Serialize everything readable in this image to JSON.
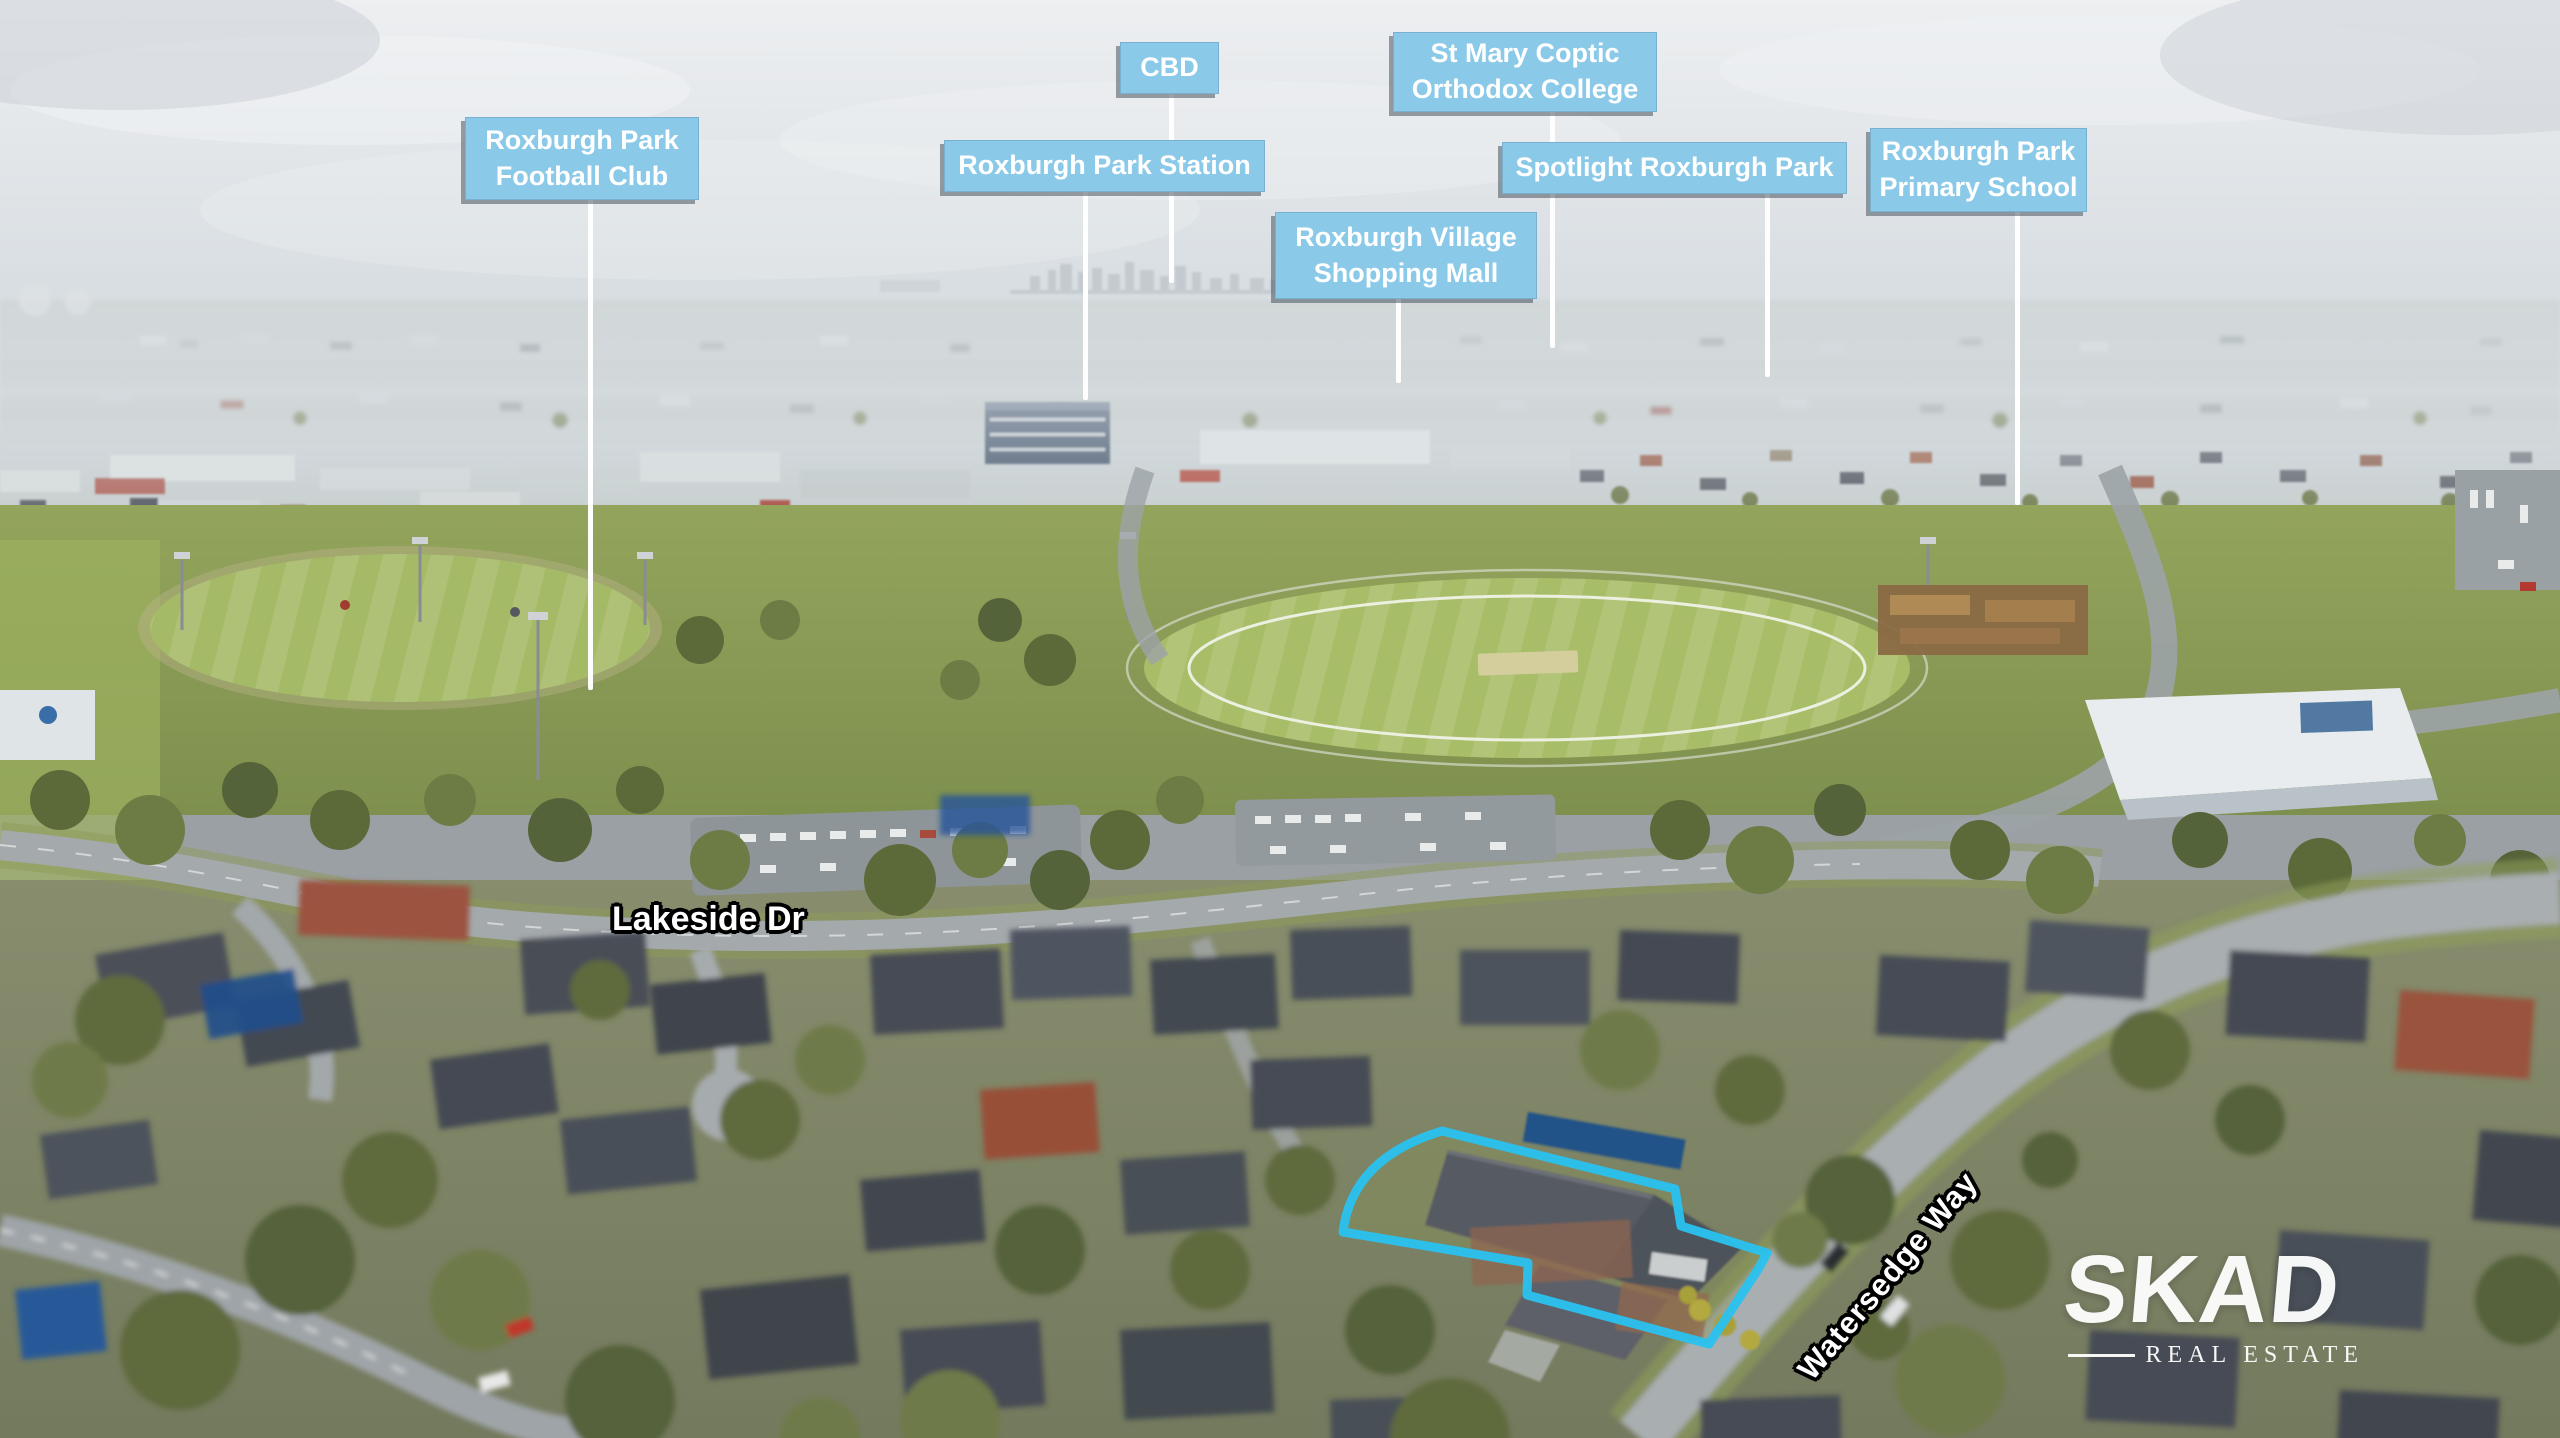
{
  "image_type": "aerial-drone-real-estate-photo",
  "callouts": [
    {
      "text": "Roxburgh Park\nFootball Club"
    },
    {
      "text": "CBD"
    },
    {
      "text": "Roxburgh Park Station"
    },
    {
      "text": "St Mary Coptic\nOrthodox College"
    },
    {
      "text": "Roxburgh Village\nShopping Mall"
    },
    {
      "text": "Spotlight Roxburgh Park"
    },
    {
      "text": "Roxburgh Park\nPrimary School"
    }
  ],
  "street_labels": [
    {
      "text": "Lakeside Dr"
    },
    {
      "text": "Watersedge Way"
    }
  ],
  "watermark": {
    "brand": "SKAD",
    "tagline": "REAL ESTATE"
  },
  "colors": {
    "callout_bg": "#8BC9E8",
    "callout_text": "#FFFFFF",
    "leader_line": "#FFFFFF",
    "property_outline": "#29C2F0",
    "street_label_text": "#FFFFFF",
    "street_label_outline": "#000000",
    "watermark_text": "#FFFFFF"
  }
}
